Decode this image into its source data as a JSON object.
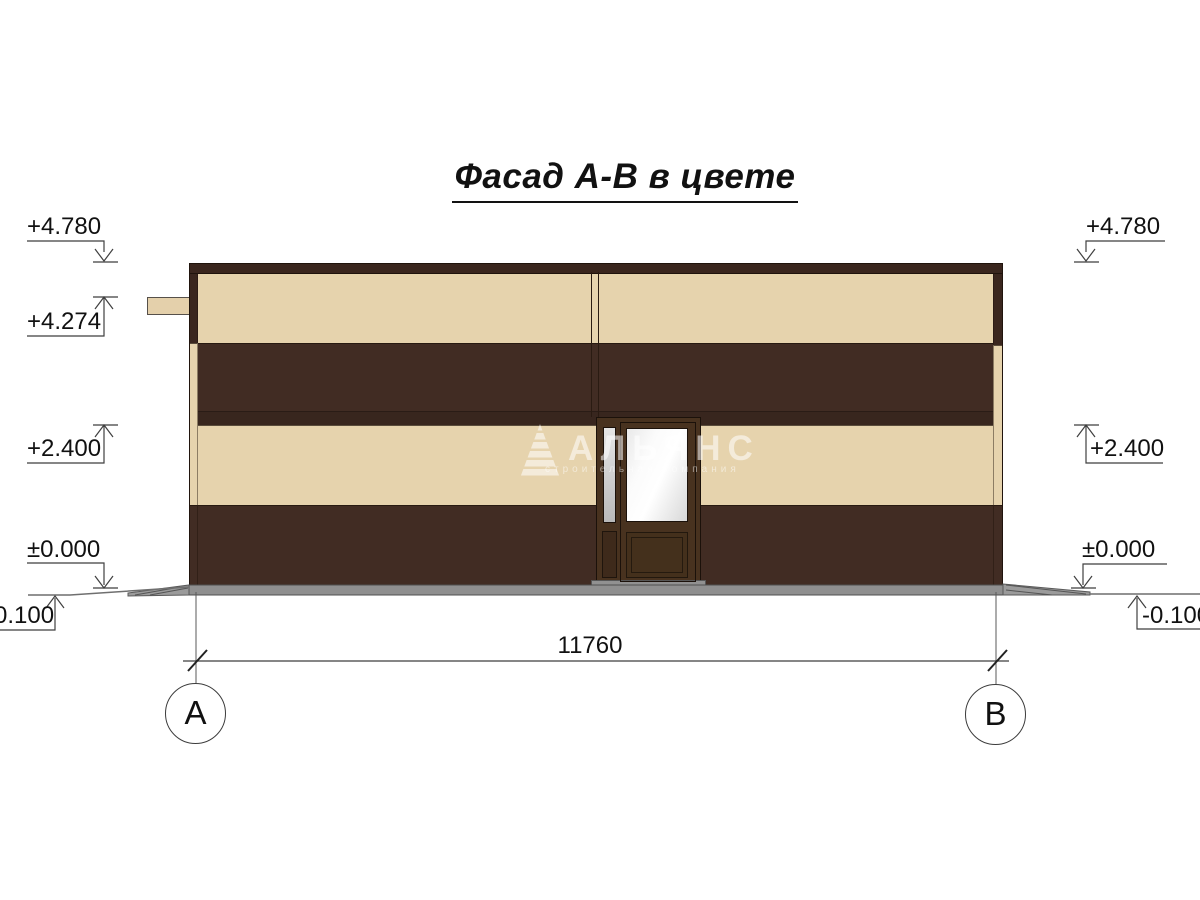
{
  "title": "Фасад А-В в цвете",
  "watermark": {
    "logo": "striped-pyramid",
    "name": "АЛЬЯНС",
    "tagline": "строительная компания"
  },
  "marks": {
    "left": [
      "+4.780",
      "+4.274",
      "+2.400",
      "±0.000",
      "-0.100"
    ],
    "right": [
      "+4.780",
      "+2.400",
      "±0.000",
      "-0.100"
    ]
  },
  "dimension": {
    "overall": "11760"
  },
  "axes": {
    "a": "А",
    "b": "В"
  },
  "colors": {
    "facade_beige": "#e6d3ad",
    "facade_brown": "#412c23",
    "roof_cap_brown": "#3a261e",
    "door_frame_brown": "#48321f",
    "plinth_gray": "#8f8f8f"
  }
}
